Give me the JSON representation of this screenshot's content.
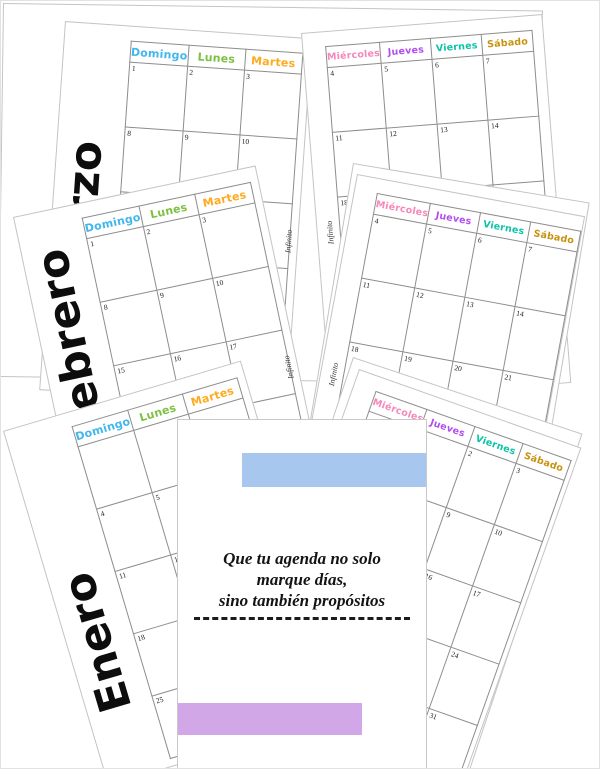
{
  "watermark": "Infinito",
  "weekdays": {
    "left": [
      {
        "label": "Domingo",
        "color": "#41b7ee"
      },
      {
        "label": "Lunes",
        "color": "#7dc142"
      },
      {
        "label": "Martes",
        "color": "#ffaa1e"
      }
    ],
    "right": [
      {
        "label": "Miércoles",
        "color": "#f787bb"
      },
      {
        "label": "Jueves",
        "color": "#b14ef2"
      },
      {
        "label": "Viernes",
        "color": "#0ec4a8"
      },
      {
        "label": "Sábado",
        "color": "#c7920e"
      }
    ]
  },
  "months": {
    "enero": {
      "label": "Enero",
      "left_days": [
        [
          "",
          "",
          ""
        ],
        [
          "4",
          "5",
          "6"
        ],
        [
          "11",
          "12",
          "13"
        ],
        [
          "18",
          "19",
          "20"
        ],
        [
          "25",
          "26",
          "27"
        ]
      ],
      "right_days": [
        [
          "",
          "1",
          "2",
          "3"
        ],
        [
          "7",
          "8",
          "9",
          "10"
        ],
        [
          "14",
          "15",
          "16",
          "17"
        ],
        [
          "21",
          "22",
          "23",
          "24"
        ],
        [
          "28",
          "29",
          "30",
          "31"
        ]
      ]
    },
    "febrero": {
      "label": "Febrero",
      "left_days": [
        [
          "1",
          "2",
          "3"
        ],
        [
          "8",
          "9",
          "10"
        ],
        [
          "15",
          "16",
          "17"
        ],
        [
          "22",
          "23",
          "24"
        ],
        [
          "",
          "",
          ""
        ]
      ],
      "right_days": [
        [
          "4",
          "5",
          "6",
          "7"
        ],
        [
          "11",
          "12",
          "13",
          "14"
        ],
        [
          "18",
          "19",
          "20",
          "21"
        ],
        [
          "25",
          "26",
          "27",
          "28"
        ],
        [
          "",
          "",
          "",
          ""
        ]
      ]
    },
    "marzo": {
      "label": "Marzo",
      "left_days": [
        [
          "1",
          "2",
          "3"
        ],
        [
          "8",
          "9",
          "10"
        ],
        [
          "15",
          "16",
          "17"
        ],
        [
          "22",
          "23",
          "24"
        ],
        [
          "29",
          "30",
          "31"
        ]
      ],
      "right_days": [
        [
          "4",
          "5",
          "6",
          "7"
        ],
        [
          "11",
          "12",
          "13",
          "14"
        ],
        [
          "18",
          "19",
          "20",
          "21"
        ],
        [
          "25",
          "26",
          "27",
          "28"
        ],
        [
          "",
          "",
          "",
          ""
        ]
      ]
    }
  },
  "cover": {
    "quote_lines": [
      "Que tu agenda no solo",
      "marque días,",
      "sino también propósitos"
    ],
    "accent_blue": "#a8c7ee",
    "accent_purple": "#d2a7e8"
  }
}
